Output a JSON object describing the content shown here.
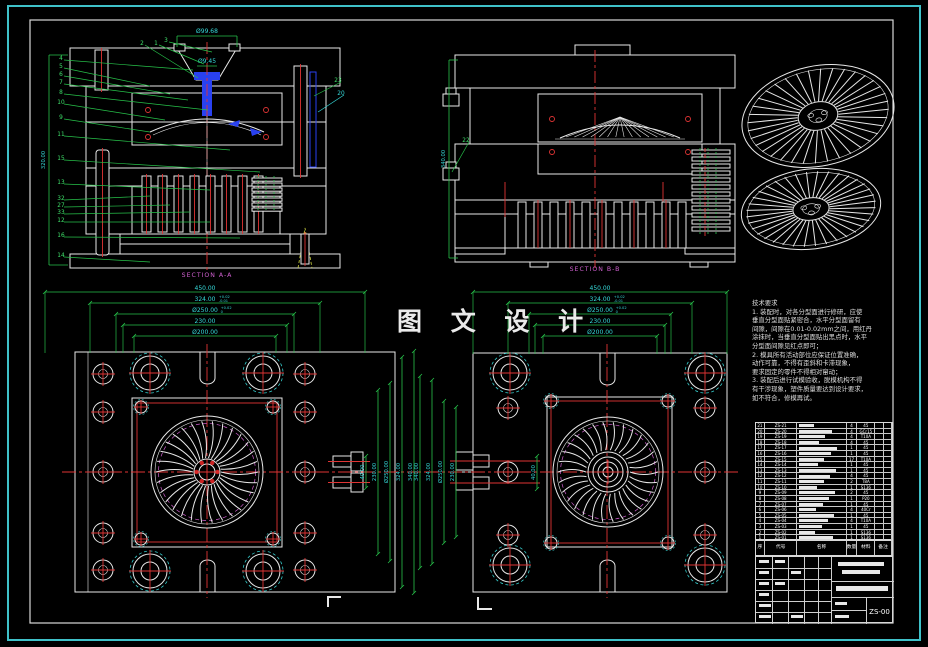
{
  "frame": {
    "watermark": "图 文 设 计"
  },
  "sections": {
    "a": {
      "label": "SECTION A-A",
      "dim_top": "Ø99.68",
      "dim_mid": "Ø9.45",
      "dim_left": "320.00",
      "callouts_left": [
        "4",
        "5",
        "6",
        "7",
        "8",
        "10",
        "9",
        "11",
        "15",
        "13",
        "32",
        "27",
        "33",
        "12",
        "16",
        "14"
      ],
      "callouts_top": [
        "2",
        "1",
        "3"
      ],
      "callouts_right": [
        "23",
        "20"
      ]
    },
    "b": {
      "label": "SECTION B-B",
      "dim_left": "340.00",
      "callouts_left": [
        "22"
      ]
    }
  },
  "plan_left": {
    "dims_top": [
      {
        "v": "450.00",
        "tol": ""
      },
      {
        "v": "324.00",
        "tol": "+0.02 -0.01"
      },
      {
        "v": "Ø250.00",
        "tol": "+0.02 0"
      },
      {
        "v": "230.00",
        "tol": ""
      },
      {
        "v": "Ø200.00",
        "tol": ""
      }
    ],
    "dims_side": [
      "40.00",
      "230.00",
      "Ø250.00",
      "324.00",
      "340.00"
    ]
  },
  "plan_right": {
    "dims_top": [
      {
        "v": "450.00",
        "tol": ""
      },
      {
        "v": "324.00",
        "tol": "+0.02 -0.01"
      },
      {
        "v": "Ø250.00",
        "tol": "+0.02 0"
      },
      {
        "v": "230.00",
        "tol": ""
      },
      {
        "v": "Ø200.00",
        "tol": ""
      }
    ],
    "dims_side": [
      "40.00",
      "230.00",
      "Ø250.00",
      "324.00",
      "340.00"
    ]
  },
  "notes": {
    "title": "技术要求",
    "lines": [
      "1. 装配时，对各分型面进行修研，应使",
      "垂直分型面贴紧密合，水平分型面留有",
      "间隙，间隙在0.01-0.02mm之间，用红丹",
      "涂抹时，当垂直分型面贴出黑点时，水平",
      "分型面间隙见红点即可；",
      "2. 模具所有活动部位应保证位置准确，",
      "动作可靠，不得有歪斜和卡滞现象，",
      "要求固定的零件不得相对窜动；",
      "3. 装配后进行试模验收，脱模机构不得",
      "有干涉现象，塑件质量要达到设计要求，",
      "如不符合，修模再试。"
    ]
  },
  "bom": {
    "headers": [
      "序号",
      "代号",
      "名称",
      "数量",
      "材料",
      "备注"
    ],
    "rows": [
      {
        "no": "21",
        "code": "ZS-21",
        "name": "",
        "qty": "4",
        "mat": "45"
      },
      {
        "no": "20",
        "code": "ZS-20",
        "name": "",
        "qty": "4",
        "mat": "GCr15"
      },
      {
        "no": "19",
        "code": "ZS-19",
        "name": "",
        "qty": "4",
        "mat": "T10A"
      },
      {
        "no": "18",
        "code": "ZS-18",
        "name": "",
        "qty": "4",
        "mat": "45"
      },
      {
        "no": "17",
        "code": "ZS-17",
        "name": "",
        "qty": "1",
        "mat": "45"
      },
      {
        "no": "16",
        "code": "ZS-16",
        "name": "",
        "qty": "1",
        "mat": "45"
      },
      {
        "no": "15",
        "code": "ZS-15",
        "name": "",
        "qty": "17",
        "mat": "T10A"
      },
      {
        "no": "14",
        "code": "ZS-14",
        "name": "",
        "qty": "1",
        "mat": "45"
      },
      {
        "no": "13",
        "code": "ZS-13",
        "name": "",
        "qty": "1",
        "mat": "45"
      },
      {
        "no": "12",
        "code": "ZS-12",
        "name": "",
        "qty": "4",
        "mat": "45"
      },
      {
        "no": "11",
        "code": "ZS-11",
        "name": "",
        "qty": "2",
        "mat": "T8A"
      },
      {
        "no": "10",
        "code": "ZS-10",
        "name": "",
        "qty": "1",
        "mat": "S136"
      },
      {
        "no": "9",
        "code": "ZS-09",
        "name": "",
        "qty": "2",
        "mat": "45"
      },
      {
        "no": "8",
        "code": "ZS-08",
        "name": "",
        "qty": "1",
        "mat": "P20"
      },
      {
        "no": "7",
        "code": "ZS-07",
        "name": "",
        "qty": "1",
        "mat": "45"
      },
      {
        "no": "6",
        "code": "ZS-06",
        "name": "",
        "qty": "4",
        "mat": "40Cr"
      },
      {
        "no": "5",
        "code": "ZS-05",
        "name": "",
        "qty": "1",
        "mat": "45"
      },
      {
        "no": "4",
        "code": "ZS-04",
        "name": "",
        "qty": "4",
        "mat": "T10A"
      },
      {
        "no": "3",
        "code": "ZS-03",
        "name": "",
        "qty": "1",
        "mat": "45"
      },
      {
        "no": "2",
        "code": "ZS-02",
        "name": "",
        "qty": "1",
        "mat": "S136"
      },
      {
        "no": "1",
        "code": "ZS-01",
        "name": "",
        "qty": "1",
        "mat": "S136"
      }
    ]
  },
  "title_block": {
    "drawing_no": "ZS-00"
  }
}
